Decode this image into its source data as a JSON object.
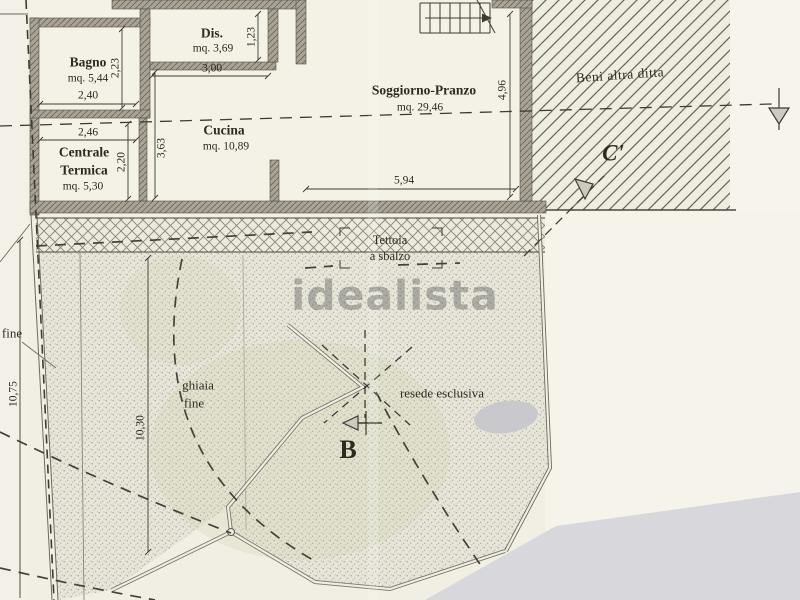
{
  "plan": {
    "watermark": "idealista",
    "rooms": {
      "bagno": {
        "name": "Bagno",
        "area": "mq. 5,44",
        "width": "2,40",
        "height": "2,23"
      },
      "dis": {
        "name": "Dis.",
        "area": "mq. 3,69",
        "width": "3,00",
        "height": "1,23"
      },
      "centrale": {
        "name_line1": "Centrale",
        "name_line2": "Termica",
        "area": "mq. 5,30",
        "width": "2,46",
        "height": "2,20"
      },
      "cucina": {
        "name": "Cucina",
        "area": "mq. 10,89",
        "height": "3,63"
      },
      "soggiorno": {
        "name": "Soggiorno-Pranzo",
        "area": "mq. 29,46",
        "width": "5,94",
        "height": "4,96"
      }
    },
    "outdoor": {
      "beni_label": "Beni altra ditta",
      "tettoia_line1": "Tettoia",
      "tettoia_line2": "a sbalzo",
      "ghiaia_line1": "ghiaia",
      "ghiaia_line2": "fine",
      "ghiaia_left_fragment": "fine",
      "resede_label": "resede esclusiva",
      "dim_left": "10,75",
      "dim_mid": "10,30"
    },
    "sections": {
      "b": "B",
      "c_prime": "C'"
    }
  }
}
